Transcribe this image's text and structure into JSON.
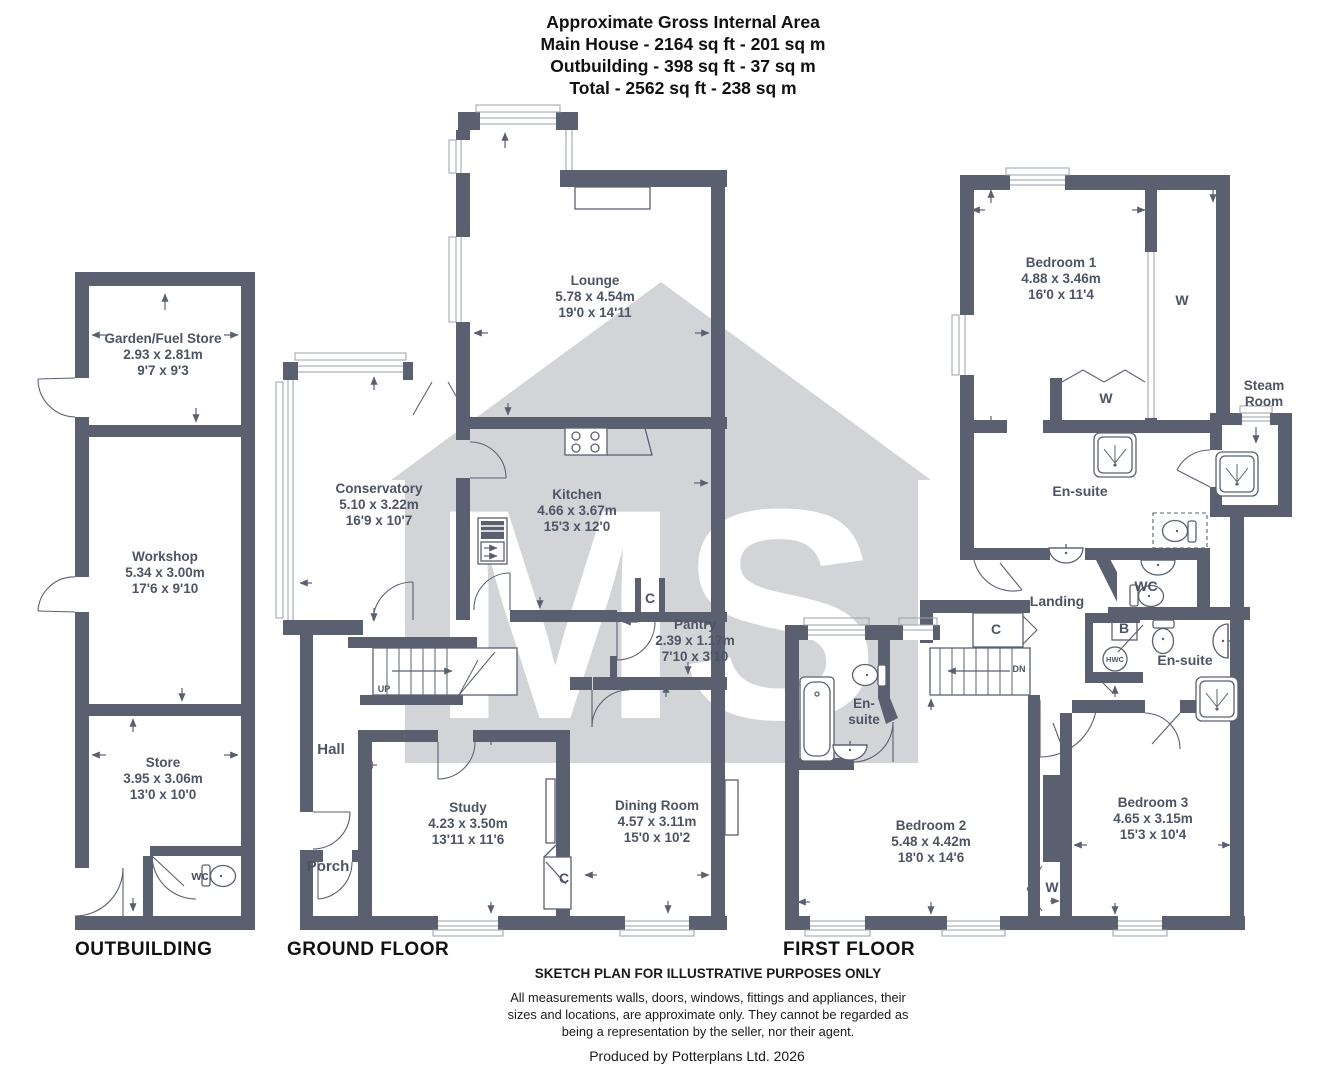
{
  "header": {
    "title": "Approximate Gross Internal Area",
    "main_house": "Main House - 2164 sq ft - 201 sq m",
    "outbuilding": "Outbuilding - 398 sq ft - 37 sq m",
    "total": "Total - 2562 sq ft - 238 sq m"
  },
  "watermark": {
    "text": "MS",
    "color": "#d3d4d8"
  },
  "colors": {
    "wall": "#5a6070",
    "label": "#4d5463"
  },
  "floors": {
    "outbuilding": "OUTBUILDING",
    "ground": "GROUND FLOOR",
    "first": "FIRST FLOOR"
  },
  "rooms": {
    "garden_fuel_store": {
      "name": "Garden/Fuel Store",
      "metric": "2.93 x 2.81m",
      "imperial": "9'7 x 9'3"
    },
    "workshop": {
      "name": "Workshop",
      "metric": "5.34 x 3.00m",
      "imperial": "17'6 x 9'10"
    },
    "store": {
      "name": "Store",
      "metric": "3.95 x 3.06m",
      "imperial": "13'0 x 10'0"
    },
    "lounge": {
      "name": "Lounge",
      "metric": "5.78 x 4.54m",
      "imperial": "19'0 x 14'11"
    },
    "conservatory": {
      "name": "Conservatory",
      "metric": "5.10 x 3.22m",
      "imperial": "16'9 x 10'7"
    },
    "kitchen": {
      "name": "Kitchen",
      "metric": "4.66 x 3.67m",
      "imperial": "15'3 x 12'0"
    },
    "pantry": {
      "name": "Pantry",
      "metric": "2.39 x 1.17m",
      "imperial": "7'10 x 3'10"
    },
    "study": {
      "name": "Study",
      "metric": "4.23 x 3.50m",
      "imperial": "13'11 x 11'6"
    },
    "dining_room": {
      "name": "Dining Room",
      "metric": "4.57 x 3.11m",
      "imperial": "15'0 x 10'2"
    },
    "bedroom1": {
      "name": "Bedroom 1",
      "metric": "4.88 x 3.46m",
      "imperial": "16'0 x 11'4"
    },
    "bedroom2": {
      "name": "Bedroom 2",
      "metric": "5.48 x 4.42m",
      "imperial": "18'0 x 14'6"
    },
    "bedroom3": {
      "name": "Bedroom 3",
      "metric": "4.65 x 3.15m",
      "imperial": "15'3 x 10'4"
    },
    "hall": {
      "name": "Hall"
    },
    "porch": {
      "name": "Porch"
    },
    "landing": {
      "name": "Landing"
    },
    "wc_upper": {
      "name": "WC"
    },
    "wc_lower": {
      "name": "wc"
    },
    "ensuite": {
      "name": "En-suite",
      "line1": "En-",
      "line2": "suite"
    },
    "steam_room": {
      "line1": "Steam",
      "line2": "Room"
    }
  },
  "tags": {
    "c": "C",
    "w": "W",
    "b": "B",
    "hwc": "HWC",
    "up": "UP",
    "dn": "DN"
  },
  "footer": {
    "title": "SKETCH PLAN FOR ILLUSTRATIVE PURPOSES ONLY",
    "line1": "All measurements walls, doors, windows, fittings and appliances, their",
    "line2": "sizes and locations, are approximate only. They cannot be regarded as",
    "line3": "being a representation by the seller, nor their agent.",
    "produced": "Produced by Potterplans Ltd. 2026"
  }
}
